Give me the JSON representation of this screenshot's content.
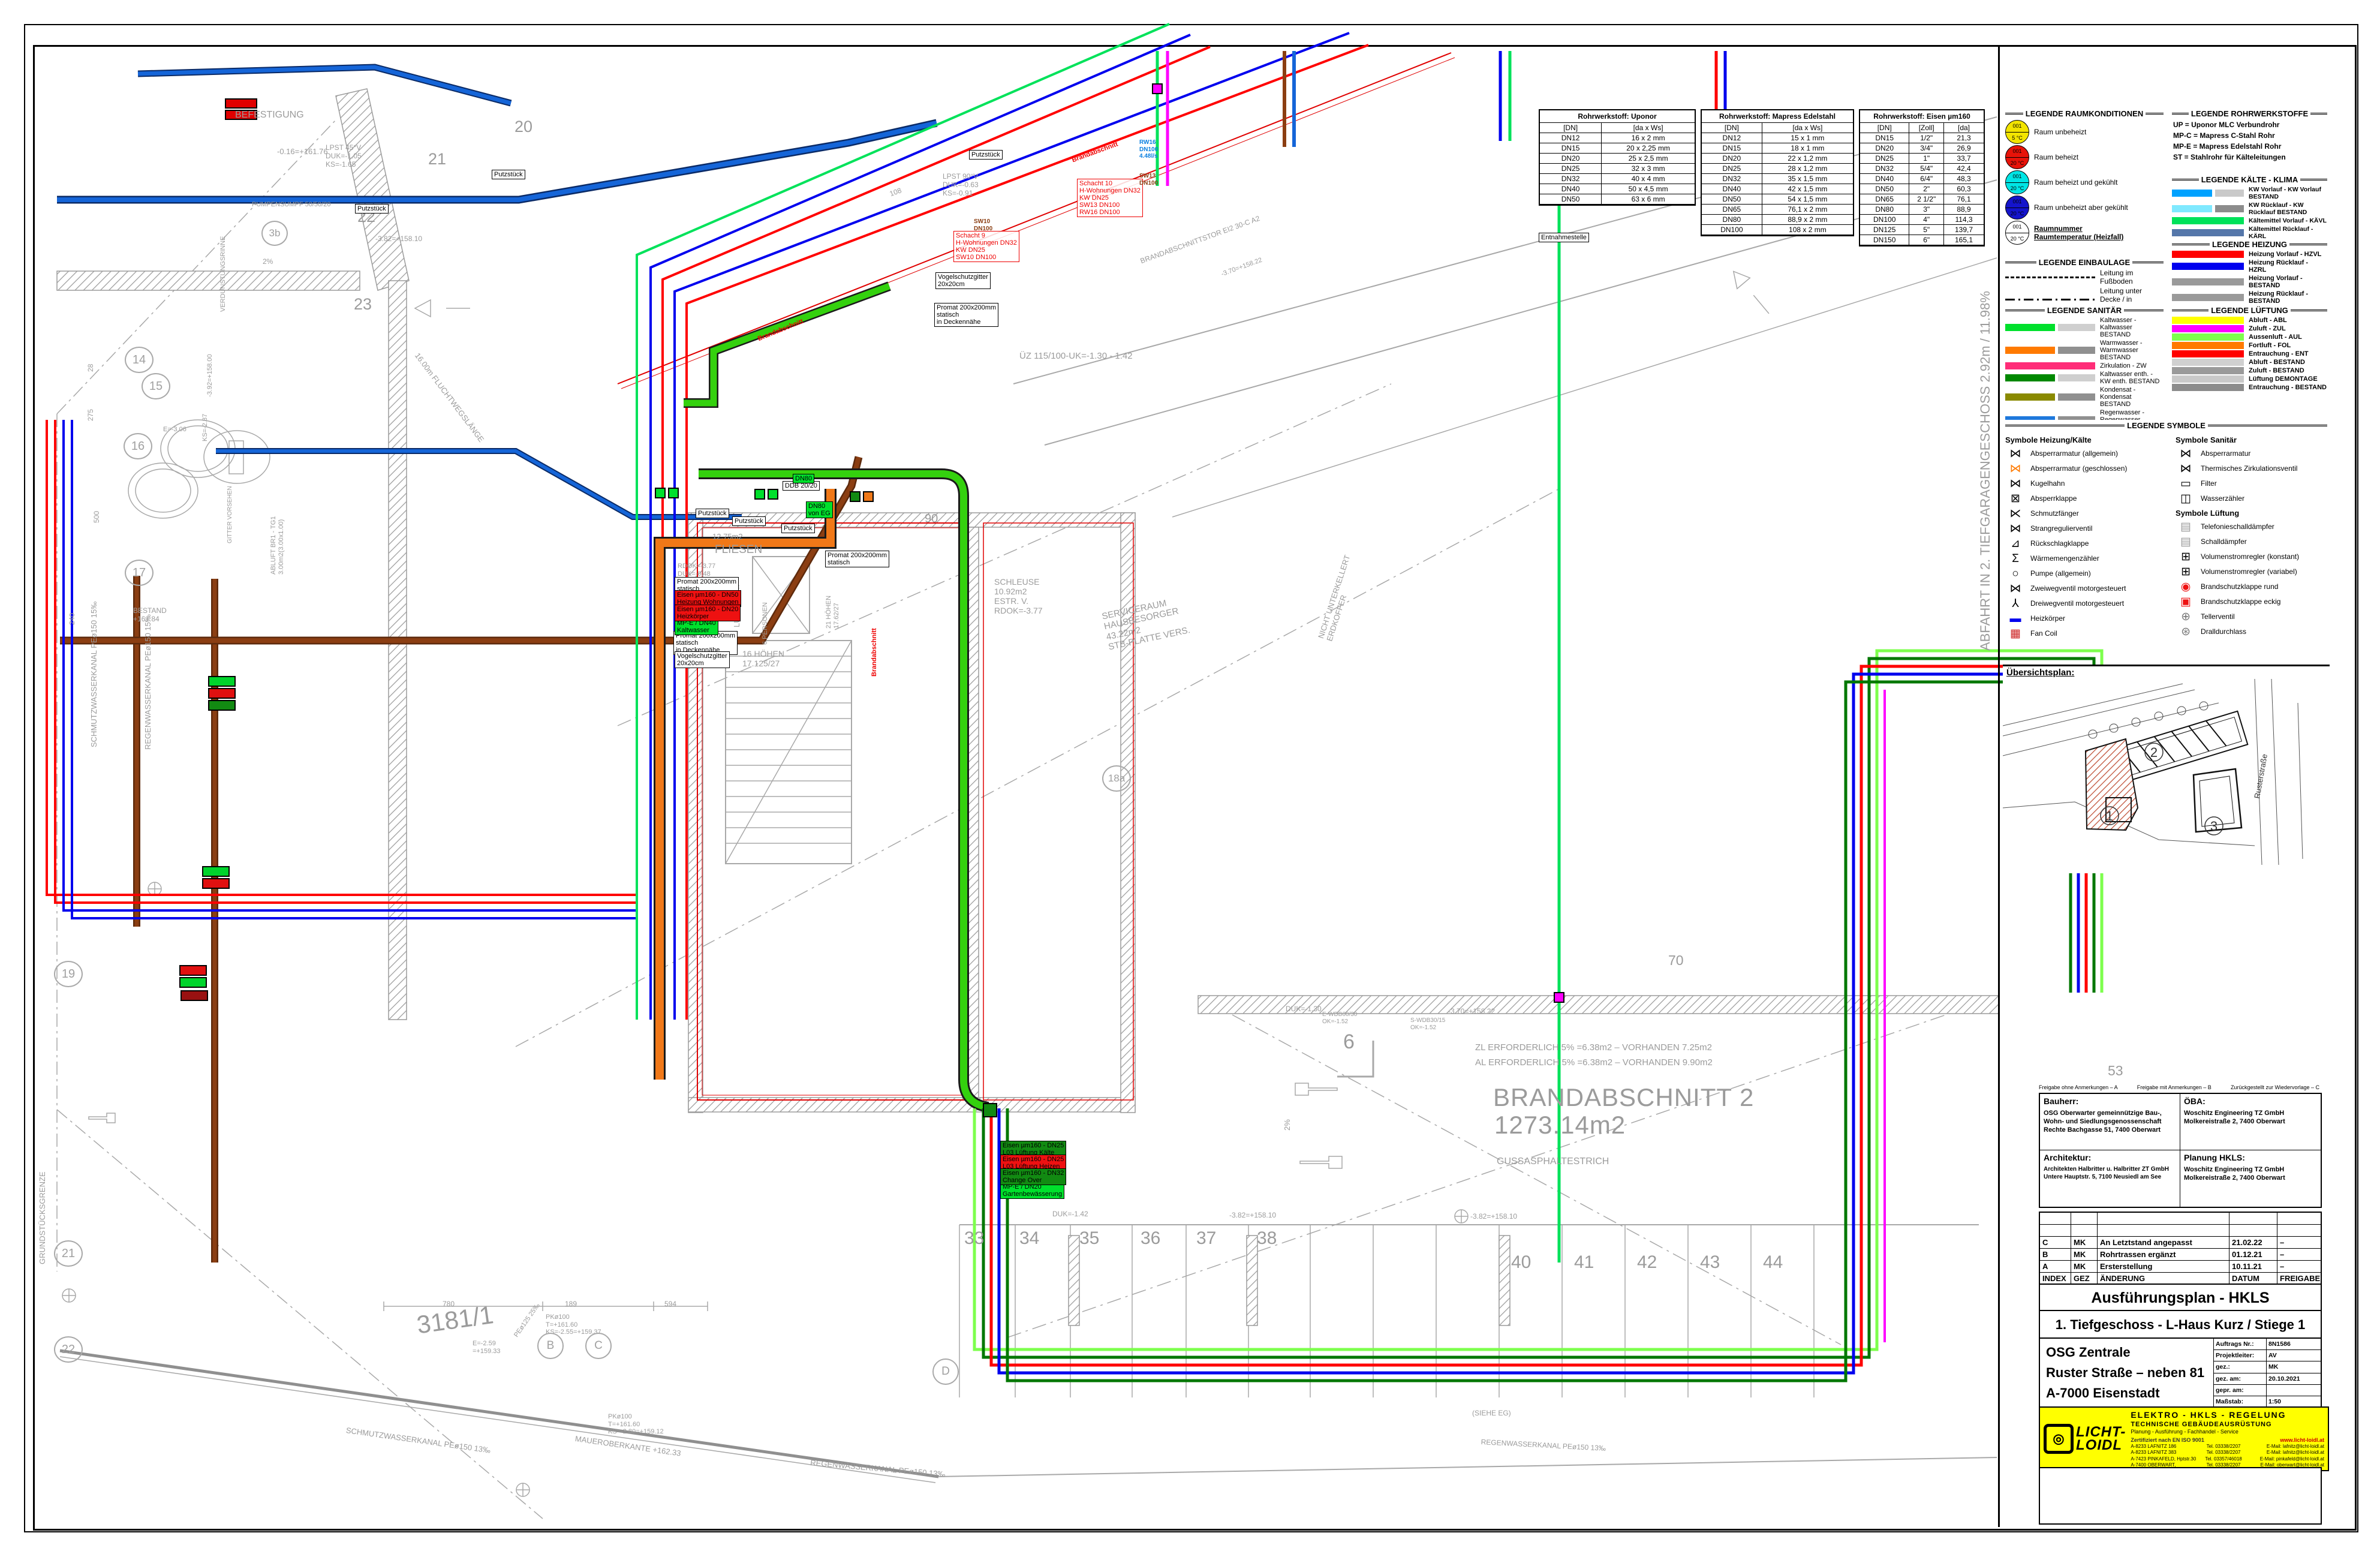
{
  "colors": {
    "hzvl": "#ff0000",
    "hzrl": "#0000ee",
    "kw": "#00a2ff",
    "kaevl": "#00e25a",
    "aul": "#7dff4d",
    "fol": "#ff7a00",
    "zul": "#ff00ff",
    "schmutz": "#8b3e12",
    "regen": "#1e78dc",
    "kaltwasser": "#00e02c",
    "bestand": "#9b9b9b"
  },
  "tables": {
    "uponor": {
      "title": "Rohrwerkstoff: Uponor",
      "cols": [
        "[DN]",
        "[da x Ws]"
      ],
      "rows": [
        [
          "DN12",
          "16 x 2 mm"
        ],
        [
          "DN15",
          "20 x 2,25 mm"
        ],
        [
          "DN20",
          "25 x 2,5 mm"
        ],
        [
          "DN25",
          "32 x 3 mm"
        ],
        [
          "DN32",
          "40 x 4 mm"
        ],
        [
          "DN40",
          "50 x 4,5 mm"
        ],
        [
          "DN50",
          "63 x 6 mm"
        ]
      ]
    },
    "mapress": {
      "title": "Rohrwerkstoff: Mapress Edelstahl",
      "cols": [
        "[DN]",
        "[da x Ws]"
      ],
      "rows": [
        [
          "DN12",
          "15 x 1 mm"
        ],
        [
          "DN15",
          "18 x 1 mm"
        ],
        [
          "DN20",
          "22 x 1,2 mm"
        ],
        [
          "DN25",
          "28 x 1,2 mm"
        ],
        [
          "DN32",
          "35 x 1,5 mm"
        ],
        [
          "DN40",
          "42 x 1,5 mm"
        ],
        [
          "DN50",
          "54 x 1,5 mm"
        ],
        [
          "DN65",
          "76,1 x 2 mm"
        ],
        [
          "DN80",
          "88,9 x 2 mm"
        ],
        [
          "DN100",
          "108 x 2 mm"
        ]
      ]
    },
    "eisen": {
      "title": "Rohrwerkstoff: Eisen µm160",
      "cols": [
        "[DN]",
        "[Zoll]",
        "[da]"
      ],
      "rows": [
        [
          "DN15",
          "1/2\"",
          "21,3"
        ],
        [
          "DN20",
          "3/4\"",
          "26,9"
        ],
        [
          "DN25",
          "1\"",
          "33,7"
        ],
        [
          "DN32",
          "5/4\"",
          "42,4"
        ],
        [
          "DN40",
          "6/4\"",
          "48,3"
        ],
        [
          "DN50",
          "2\"",
          "60,3"
        ],
        [
          "DN65",
          "2 1/2\"",
          "76,1"
        ],
        [
          "DN80",
          "3\"",
          "88,9"
        ],
        [
          "DN100",
          "4\"",
          "114,3"
        ],
        [
          "DN125",
          "5\"",
          "139,7"
        ],
        [
          "DN150",
          "6\"",
          "165,1"
        ]
      ]
    }
  },
  "legends": {
    "raumkonditionen": {
      "title": "LEGENDE RAUMKONDITIONEN",
      "items": [
        {
          "num": "001",
          "temp": "5 °C",
          "color": "#f2e400",
          "label": "Raum unbeheizt"
        },
        {
          "num": "001",
          "temp": "20 °C",
          "color": "#e81309",
          "label": "Raum beheizt"
        },
        {
          "num": "001",
          "temp": "20 °C",
          "color": "#00e5e5",
          "label": "Raum beheizt und gekühlt"
        },
        {
          "num": "001",
          "temp": "20 °C",
          "color": "#1414cc",
          "label": "Raum unbeheizt aber gekühlt"
        }
      ],
      "callout": {
        "num": "001",
        "temp": "20 °C",
        "line1": "Raumnummer",
        "line2": "Raumtemperatur (Heizfall)"
      }
    },
    "einbaulage": {
      "title": "LEGENDE EINBAULAGE",
      "items": [
        {
          "label": "Leitung im Fußboden",
          "cls": "ln-dashed"
        },
        {
          "label": "Leitung unter Decke / in Zwischendecke",
          "cls": "ln-dashdot"
        },
        {
          "label": "Leitung Aufputz / in Wand",
          "cls": "ln-solid"
        }
      ]
    },
    "rohrwerkstoffe": {
      "title": "LEGENDE ROHRWERKSTOFFE",
      "items": [
        "UP = Uponor MLC Verbundrohr",
        "MP-C = Mapress C-Stahl Rohr",
        "MP-E = Mapress Edelstahl Rohr",
        "ST = Stahlrohr für Kälteleitungen"
      ]
    },
    "kaelte": {
      "title": "LEGENDE KÄLTE - KLIMA",
      "items": [
        {
          "c1": "#00a2ff",
          "c2": "#c9c9c9",
          "label": "KW Vorlauf - KW Vorlauf BESTAND"
        },
        {
          "c1": "#7fe9ff",
          "c2": "#8c8c8c",
          "label": "KW Rücklauf - KW Rücklauf BESTAND"
        },
        {
          "c1": "#00e25a",
          "c2": "",
          "label": "Kältemittel Vorlauf - KÄVL"
        },
        {
          "c1": "#5577aa",
          "c2": "",
          "label": "Kältemittel Rücklauf - KÄRL"
        },
        {
          "c1": "#8fe3a0",
          "c2": "#8c8c8c",
          "label": "Rückkühler Vorlauf - RK Vorlauf BESTAND"
        },
        {
          "c1": "#11dd11",
          "c2": "#c9c9c9",
          "label": "Rückkühler Rücklauf - RK Rücklauf BEST."
        }
      ]
    },
    "heizung": {
      "title": "LEGENDE HEIZUNG",
      "items": [
        {
          "c1": "#ff0000",
          "c2": "",
          "label": "Heizung Vorlauf - HZVL"
        },
        {
          "c1": "#0000ee",
          "c2": "",
          "label": "Heizung Rücklauf - HZRL"
        },
        {
          "c1": "#9a9a9a",
          "c2": "",
          "label": "Heizung Vorlauf - BESTAND"
        },
        {
          "c1": "#9a9a9a",
          "c2": "",
          "label": "Heizung Rücklauf - BESTAND"
        },
        {
          "c1": "#b22222",
          "c2": "",
          "label": "Heizung - DEMONTAGE"
        }
      ]
    },
    "sanitaer": {
      "title": "LEGENDE SANITÄR",
      "items": [
        {
          "c1": "#00e02c",
          "c2": "#cfcfcf",
          "label": "Kaltwasser - Kaltwasser BESTAND"
        },
        {
          "c1": "#ff7a00",
          "c2": "#909090",
          "label": "Warmwasser - Warmwasser BESTAND"
        },
        {
          "c1": "#ff2d78",
          "c2": "",
          "label": "Zirkulation - ZW"
        },
        {
          "c1": "#008800",
          "c2": "#cfcfcf",
          "label": "Kaltwasser enth. - KW enth. BESTAND"
        },
        {
          "c1": "#8a8a00",
          "c2": "#909090",
          "label": "Kondensat - Kondensat BESTAND"
        },
        {
          "c1": "#1e78dc",
          "c2": "#909090",
          "label": "Regenwasser - Regenwasser BESTAND"
        },
        {
          "c1": "#8b3e12",
          "c2": "#909090",
          "label": "Schmutzwasser - Schmutzw. BESTAND"
        },
        {
          "c1": "#ff0000",
          "c2": "#909090",
          "label": "Löschwasser - Löschwasser BESTAND"
        },
        {
          "c1": "#d6d600",
          "c2": "#cfcfcf",
          "label": "Erdgas - Erdgas BESTAND"
        }
      ]
    },
    "lueftung": {
      "title": "LEGENDE LÜFTUNG",
      "items": [
        {
          "c1": "#ffff00",
          "c2": "",
          "label": "Abluft - ABL"
        },
        {
          "c1": "#ff00ff",
          "c2": "",
          "label": "Zuluft - ZUL"
        },
        {
          "c1": "#7dff4d",
          "c2": "",
          "label": "Aussenluft - AUL"
        },
        {
          "c1": "#ff7a00",
          "c2": "",
          "label": "Fortluft - FOL"
        },
        {
          "c1": "#ff0000",
          "c2": "",
          "label": "Entrauchung - ENT"
        },
        {
          "c1": "#d0d0d0",
          "c2": "",
          "label": "Abluft - BESTAND"
        },
        {
          "c1": "#9a9a9a",
          "c2": "",
          "label": "Zuluft - BESTAND"
        },
        {
          "c1": "#c9c9c9",
          "c2": "",
          "label": "Lüftung DEMONTAGE"
        },
        {
          "c1": "#8c8c8c",
          "c2": "",
          "label": "Entrauchung - BESTAND"
        }
      ]
    },
    "symbole": {
      "title": "LEGENDE SYMBOLE",
      "left_title": "Symbole Heizung/Kälte",
      "right_title": "Symbole Sanitär",
      "vent_title": "Symbole Lüftung",
      "heizkaelte": [
        {
          "g": "⋈",
          "c": "#000",
          "label": "Absperrarmatur (allgemein)"
        },
        {
          "g": "⋈",
          "c": "#ff7a00",
          "label": "Absperrarmatur (geschlossen)"
        },
        {
          "g": "⋈",
          "c": "#000",
          "label": "Kugelhahn"
        },
        {
          "g": "⊠",
          "c": "#000",
          "label": "Absperrklappe"
        },
        {
          "g": "⋉",
          "c": "#000",
          "label": "Schmutzfänger"
        },
        {
          "g": "⋈",
          "c": "#000",
          "label": "Strangregulierventil"
        },
        {
          "g": "⊿",
          "c": "#000",
          "label": "Rückschlagklappe"
        },
        {
          "g": "Σ",
          "c": "#000",
          "label": "Wärmemengenzähler"
        },
        {
          "g": "○",
          "c": "#000",
          "label": "Pumpe (allgemein)"
        },
        {
          "g": "⋈",
          "c": "#000",
          "label": "Zweiwegventil motorgesteuert"
        },
        {
          "g": "⅄",
          "c": "#000",
          "label": "Dreiwegventil motorgesteuert"
        },
        {
          "g": "▬",
          "c": "#0000ee",
          "label": "Heizkörper"
        },
        {
          "g": "▦",
          "c": "#cc2222",
          "label": "Fan Coil"
        }
      ],
      "sanitaer": [
        {
          "g": "⋈",
          "c": "#000",
          "label": "Absperrarmatur"
        },
        {
          "g": "⋈",
          "c": "#000",
          "label": "Thermisches Zirkulationsventil"
        },
        {
          "g": "▭",
          "c": "#000",
          "label": "Filter"
        },
        {
          "g": "◫",
          "c": "#000",
          "label": "Wasserzähler"
        }
      ],
      "lueftung": [
        {
          "g": "▤",
          "c": "#9a9a9a",
          "label": "Telefonieschalldämpfer"
        },
        {
          "g": "▤",
          "c": "#9a9a9a",
          "label": "Schalldämpfer"
        },
        {
          "g": "⊞",
          "c": "#000",
          "label": "Volumenstromregler (konstant)"
        },
        {
          "g": "⊞",
          "c": "#000",
          "label": "Volumenstromregler (variabel)"
        },
        {
          "g": "◉",
          "c": "#ee1111",
          "label": "Brandschutzklappe rund"
        },
        {
          "g": "▣",
          "c": "#ee1111",
          "label": "Brandschutzklappe eckig"
        },
        {
          "g": "⊕",
          "c": "#777",
          "label": "Tellerventil"
        },
        {
          "g": "⊛",
          "c": "#777",
          "label": "Dralldurchlass"
        }
      ]
    }
  },
  "uebersichtsplan": {
    "title": "Übersichtsplan:",
    "street": "Rusterstraße",
    "b1": "1",
    "b2": "2",
    "b3": "3"
  },
  "stamp": {
    "freigabe_a": "Freigabe ohne Anmerkungen – A",
    "freigabe_b": "Freigabe mit Anmerkungen – B",
    "freigabe_c": "Zurückgestellt zur Wiedervorlage – C",
    "bauherr_title": "Bauherr:",
    "bauherr": "OSG Oberwarter gemeinnützige Bau-,\nWohn- und Siedlungsgenossenschaft\nRechte Bachgasse 51, 7400 Oberwart",
    "oeba_title": "ÖBA:",
    "oeba": "Woschitz Engineering TZ GmbH\nMolkereistraße 2, 7400 Oberwart",
    "arch_title": "Architektur:",
    "arch": "Architekten Halbritter u. Halbritter ZT GmbH\nUntere Hauptstr. 5, 7100 Neusiedl am See",
    "planung_title": "Planung HKLS:",
    "planung": "Woschitz Engineering TZ GmbH\nMolkereistraße 2, 7400 Oberwart"
  },
  "revisions": {
    "rows": [
      [
        "",
        "",
        "",
        "",
        ""
      ],
      [
        "",
        "",
        "",
        "",
        ""
      ],
      [
        "C",
        "MK",
        "An Letztstand angepasst",
        "21.02.22",
        "–"
      ],
      [
        "B",
        "MK",
        "Rohrtrassen ergänzt",
        "01.12.21",
        "–"
      ],
      [
        "A",
        "MK",
        "Ersterstellung",
        "10.11.21",
        "–"
      ],
      [
        "INDEX",
        "GEZ",
        "ÄNDERUNG",
        "DATUM",
        "FREIGABE"
      ]
    ]
  },
  "titleblock": {
    "plan_type": "Ausführungsplan - HKLS",
    "plan_title": "1. Tiefgeschoss - L-Haus Kurz / Stiege 1",
    "project": [
      "OSG Zentrale",
      "Ruster Straße – neben 81",
      "A-7000 Eisenstadt"
    ],
    "fields": [
      {
        "k": "Auftrags Nr.:",
        "v": "8N1586"
      },
      {
        "k": "Projektleiter:",
        "v": "AV"
      },
      {
        "k": "gez.:",
        "v": "MK"
      },
      {
        "k": "gez. am:",
        "v": "20.10.2021"
      },
      {
        "k": "gepr. am:",
        "v": ""
      },
      {
        "k": "Maßstab:",
        "v": "1:50"
      }
    ]
  },
  "company": {
    "logo1": "LICHT-",
    "logo2": "LOIDL",
    "ring": "◎",
    "line1": "ELEKTRO - HKLS - REGELUNG",
    "line2": "TECHNISCHE GEBÄUDEAUSRÜSTUNG",
    "line3": "Planung - Ausführung - Fachhandel - Service",
    "cert": "Zertifiziert nach EN ISO 9001",
    "web": "www.licht-loidl.at",
    "rows": [
      {
        "a": "A-8233 LAFNITZ 186",
        "t": "Tel. 03338/2207",
        "e": "E-Mail: lafnitz@licht-loidl.at"
      },
      {
        "a": "A-8233 LAFNITZ 383",
        "t": "Tel. 03338/2207",
        "e": "E-Mail: lafnitz@licht-loidl.at"
      },
      {
        "a": "A-7423 PINKAFELD, Hptstr.30",
        "t": "Tel. 03357/46018",
        "e": "E-Mail: pinkafeld@licht-loidl.at"
      },
      {
        "a": "A-7400 OBERWART, Wienerstr. 8a/2.Stock",
        "t": "Tel. 03338/2207",
        "e": "E-Mail: oberwart@licht-loidl.at"
      }
    ]
  },
  "plan": {
    "t": {
      "befest": "BEFESTIGUNG",
      "minus016": "-0.16=+161.76",
      "lpst45": "LPST 45°V\nDUK=-1.05\nKS=-1.65",
      "lpst90": "LPST 90°V\nDUK=-0.63\nKS=-0.91",
      "g20": "20",
      "g21": "21",
      "g22": "22",
      "g23": "23",
      "g6": "6",
      "g53": "53",
      "g70": "70",
      "g90": "90",
      "lev158_10": "-3.82=+158.10",
      "lev158_22": "-3.70=+158.22",
      "fluchtweg": "16.00m FLUCHTWEGSLÄNGE",
      "pumpensumpf": "PUMPENSUMPF 50/50/20",
      "verdun": "VERDUNSTUNGSRINNE",
      "e306": "E=-3.06",
      "ks287": "KS=-2.87",
      "m392": "-3.92=+158.00",
      "d28": "28",
      "d275": "275",
      "d500": "500",
      "d240": "240",
      "d108": "108",
      "d780": "780",
      "d189": "189",
      "d594": "594",
      "pct2": "2%",
      "schmv": "SCHMUTZWASSERKANAL PEø150 15‰",
      "regv": "REGENWASSERKANAL PEø150 15‰",
      "schmb": "SCHMUTZWASSERKANAL PEø150 13‰",
      "regb": "REGENWASSERKANAL PEø150 13‰",
      "abluftbr": "ABLUFT BR1 - TG1\n3.00m2(3.00x1.00)",
      "gitter": "GITTER VORSEHEN",
      "bestand1": "BESTAND\n+161.84",
      "grenz": "GRUNDSTÜCKSGRENZE",
      "fliesen": "FLIESEN",
      "m1275": "12.75m2",
      "rdok": "RDOK=-3.77\nDUK=-0.48",
      "luftraum": "LUFTRAUM",
      "personen": "6 PERSONEN",
      "hoehen21": "21 HÖHEN\n17.62/27",
      "hoehen16": "16 HÖHEN\n17.125/27",
      "schleuse": "SCHLEUSE\n10.92m2\nESTR. V.\nRDOK=-3.77",
      "serviceraum": "SERVICERAUM\nHAUSBESORGER\n43.22m2\nSTB-PLATTE VERS.",
      "brandtor": "BRANDABSCHNITTSTOR EI2 30-C A2",
      "uz115": "ÜZ 115/100-UK=-1.30 - 1.42",
      "nicht": "NICHT UNTERKELLERT\nERDKOFFER",
      "duk130": "DUK=-1.30",
      "duk142": "DUK=-1.42",
      "ewdb": "E-WDB60/30\nOK=-1.52",
      "swdb": "S-WDB30/15\nOK=-1.52",
      "zl": "ZL ERFORDERLICH 5% =6.38m2 – VORHANDEN 7.25m2",
      "al": "AL ERFORDERLICH 5% =6.38m2 – VORHANDEN 9.90m2",
      "brand1": "BRANDABSCHNITT 2",
      "brand2": "1273.14m2",
      "guss": "GUSSASPHALTESTRICH",
      "abfahrt": "ABFAHRT IN 2. TIEFGARAGENGESCHOSS 2.92m / 11.98%",
      "niv": "=-6.26 - NIV\n=+155.46",
      "maob": "MAUEROBERKANTE +162.33",
      "parcel": "3181/1",
      "pk1": "PKø100\nT=+161.60\nKS=-2.55=+159.37",
      "pk2": "PKø100\nT=+161.60\nKS=-2.80=+159.12",
      "e259": "E=-2.59\n=+159.33",
      "pe125": "PEø125 25‰",
      "siehe": "(SIEHE EG)",
      "brandab": "Brandabschnitt"
    },
    "grid_bubbles": {
      "b14": "14",
      "b15": "15",
      "b16": "16",
      "b17": "17",
      "b19": "19",
      "b21": "21",
      "b22": "22",
      "b3b": "3b",
      "b18a": "18a",
      "bB": "B",
      "bC": "C",
      "bD": "D"
    },
    "parking1": [
      "33",
      "34",
      "35",
      "36",
      "37",
      "38"
    ],
    "parking2": [
      "40",
      "41",
      "42",
      "43",
      "44"
    ],
    "boxes": {
      "putz": "Putzstück",
      "promat": "Promat 200x200mm\nstatisch",
      "promat_d": "Promat 200x200mm\nstatisch\nin Deckennähe",
      "vogel": "Vogelschutzgitter\n20x20cm",
      "ddb": "DDB 20/20",
      "entn": "Entnahmestelle",
      "dn80": "DN80",
      "dn80eg": "DN80\nvon EG",
      "kw40": "MP-E / DN40\nKaltwasser",
      "garten": "MP-E / DN20\nGartenbewässerung",
      "hzg50": "Eisen µm160 - DN50\nHeizung Wohnungen",
      "hk20": "Eisen µm160 - DN20\nHeizkörper",
      "l03k": "Eisen µm160 - DN25\nL03 Lüftung Kälte",
      "l03h": "Eisen µm160 - DN25\nL03 Lüftung Heizen",
      "chov": "Eisen µm160 - DN32\nChange Over",
      "s9": "Schacht 9\nH-Wohnungen DN32\nKW DN25\nSW10 DN100",
      "s10": "Schacht 10\nH-Wohnungen DN32\nKW DN25\nSW13 DN100\nRW16 DN100",
      "rw16": "RW16\nDN100\n4.48l/s",
      "sw13": "SW13\nDN100",
      "sw10": "SW10\nDN100"
    }
  }
}
